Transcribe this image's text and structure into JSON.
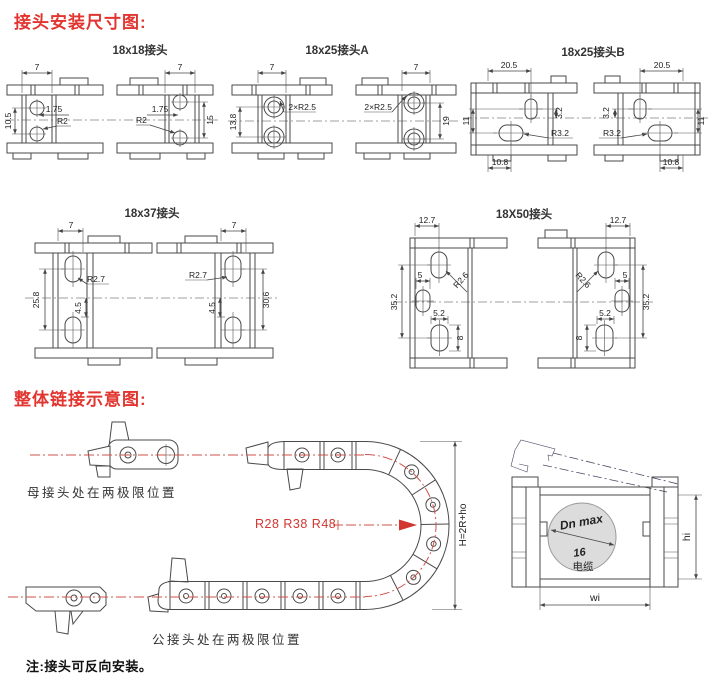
{
  "page": {
    "title_connectors": "接头安装尺寸图:",
    "title_assembly": "整体链接示意图:",
    "note": "注:接头可反向安装。"
  },
  "colors": {
    "accent_red": "#e23530",
    "centerline_red": "#d2524c",
    "line": "#4a4a4a",
    "circle_fill": "#dcdcdc"
  },
  "diagrams": {
    "d18x18": {
      "label": "18x18接头",
      "dims": {
        "top": "7",
        "pitch_left": "10.5",
        "offset": "1.75",
        "radius": "R2",
        "pitch_right": "15"
      }
    },
    "d18x25a": {
      "label": "18x25接头A",
      "dims": {
        "top": "7",
        "pitch_left": "13.8",
        "radius": "2×R2.5",
        "pitch_right": "19"
      }
    },
    "d18x25b": {
      "label": "18x25接头B",
      "dims": {
        "top": "20.5",
        "slot_offset": "3.2",
        "pitch": "11",
        "radius": "R3.2",
        "bottom": "10.8"
      }
    },
    "d18x37": {
      "label": "18x37接头",
      "dims": {
        "top": "7",
        "pitch_left": "25.8",
        "inner": "4.5",
        "radius": "R2.7",
        "pitch_right": "30.6"
      }
    },
    "d18x50": {
      "label": "18X50接头",
      "dims": {
        "top": "12.7",
        "pitch": "35.2",
        "mid": "5",
        "slot_w": "5.2",
        "slot_h": "8",
        "radius": "R2.6"
      }
    }
  },
  "assembly": {
    "female_label": "母接头处在两极限位置",
    "male_label": "公接头处在两极限位置",
    "bend_radii": "R28 R38 R48",
    "height_formula": "H=2R+ho",
    "cross_section": {
      "cable_dia": "Dn max",
      "cable_value": "16",
      "cable_text": "电缆",
      "height": "hi",
      "width": "wi"
    }
  }
}
